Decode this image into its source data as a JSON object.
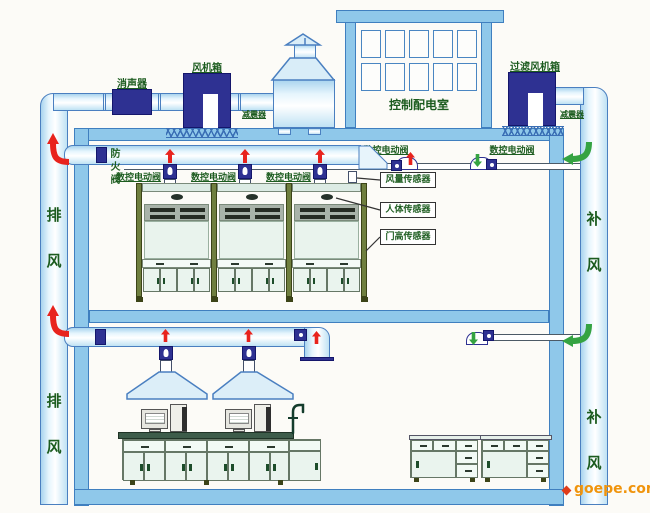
{
  "palette": {
    "duct_outline": "#4a7fc0",
    "duct_fill": "#e6f5fd",
    "navy_equipment": "#2e3192",
    "wall_fill": "#8fc8ea",
    "label_green": "#1c5c1f",
    "exhaust_arrow_red": "#e8231d",
    "supply_arrow_green": "#35a342",
    "hood_frame_olive": "#6f7f3f",
    "watermark_orange": "#f0940c"
  },
  "rooftop": {
    "silencer": "消声器",
    "fan_box": "风机箱",
    "shock_absorber_left": "减震器",
    "control_room": "控制配电室",
    "filter_fan_box": "过滤风机箱",
    "shock_absorber_right": "减震器"
  },
  "shafts": {
    "exhaust_upper": "排风",
    "exhaust_lower": "排风",
    "supply_upper": "补风",
    "supply_lower": "补风"
  },
  "upper_floor": {
    "fire_damper": "防火阀",
    "cnc_valve": "数控电动阀",
    "sensors": {
      "air_flow": "风量传感器",
      "human": "人体传感器",
      "door_height": "门高传感器"
    }
  },
  "watermark": {
    "text": "goepe.com"
  }
}
